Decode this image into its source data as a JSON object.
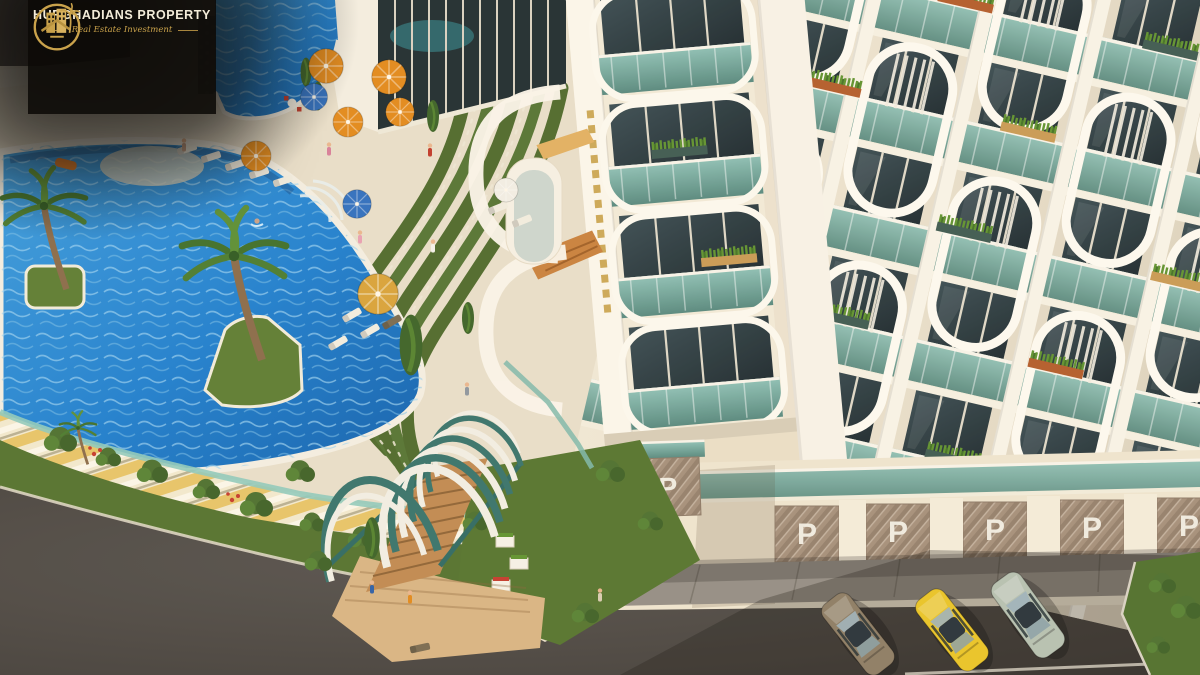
{
  "image": {
    "kind": "3D aerial architectural rendering",
    "subject": "Resort apartment complex with lagoon pool, sun deck, arched garden pergola and street-level parking garages"
  },
  "watermark": {
    "brand": "HURGHADIANS PROPERTY",
    "tagline": "Real Estate Investment",
    "logo": "gold ring emblem with buildings and palm tree",
    "colors": {
      "background": "#0d0b08",
      "gold": "#c9a24b",
      "text": "#f3ecd9"
    }
  },
  "parking": {
    "label": "P",
    "doors_visible": 6,
    "door_color": "#a5907c"
  },
  "scene": {
    "pool": {
      "water_color": "#1e7fd0",
      "floats": [
        "orange pool float"
      ],
      "swimmers": 1
    },
    "umbrellas": {
      "orange": 6,
      "blue": 2,
      "straw": 1,
      "white": 1
    },
    "umbrella_colors": {
      "orange": "#e2891c",
      "blue": "#2f6fc0",
      "straw": "#d8a33a",
      "white": "#f2efe6"
    },
    "building": {
      "facade": "#f2ead9",
      "balcony_glass": "#6fa79e",
      "frames": "#fcf9f1",
      "windows": "#26343a",
      "planters": [
        "grass",
        "copper",
        "wood"
      ]
    },
    "pergola": {
      "type": "arched tunnel over wooden stairs",
      "arch_color": "#37736c"
    },
    "cars": [
      {
        "name": "brown sedan",
        "color": "#8d7d66"
      },
      {
        "name": "yellow sedan",
        "color": "#e9c427"
      },
      {
        "name": "silver sedan",
        "color": "#b6c1b3"
      }
    ],
    "landscape": {
      "grass": "#5d7d33",
      "asphalt": "#4a4643",
      "deck": "#ece3d1",
      "wall_stripes": "#e7c469"
    }
  }
}
